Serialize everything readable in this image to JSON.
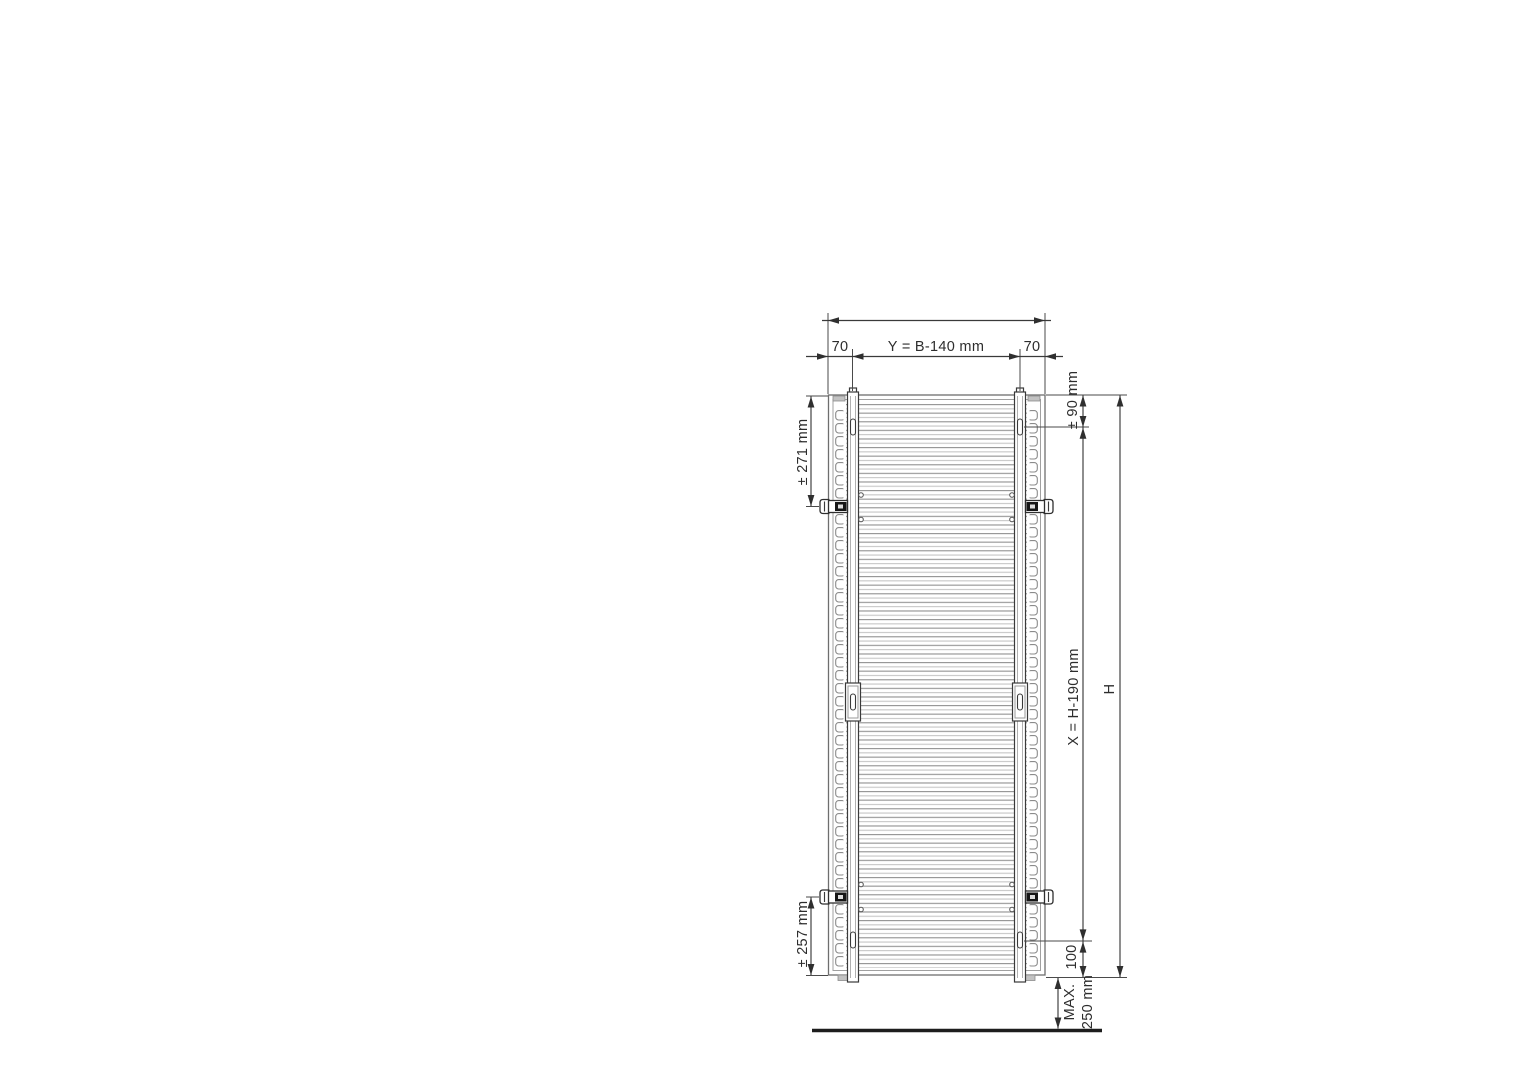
{
  "diagram": {
    "labels": {
      "overall_width_left_offset": "70",
      "overall_width_center_span": "Y = B-140 mm",
      "overall_width_right_offset": "70",
      "top_mount_offset": "± 90 mm",
      "upper_bracket_range": "± 271 mm",
      "mount_span": "X = H-190 mm",
      "overall_height": "H",
      "bottom_mount_offset": "100",
      "lower_bracket_range": "± 257 mm",
      "floor_clearance_line1": "MAX.",
      "floor_clearance_line2": "250 mm"
    },
    "colors": {
      "line": "#3a3a3a",
      "frame": "#6e6e6e",
      "tube_dark": "#969696",
      "tube_light": "#c6c6c6",
      "bracket_black": "#161616",
      "background": "#ffffff"
    }
  }
}
